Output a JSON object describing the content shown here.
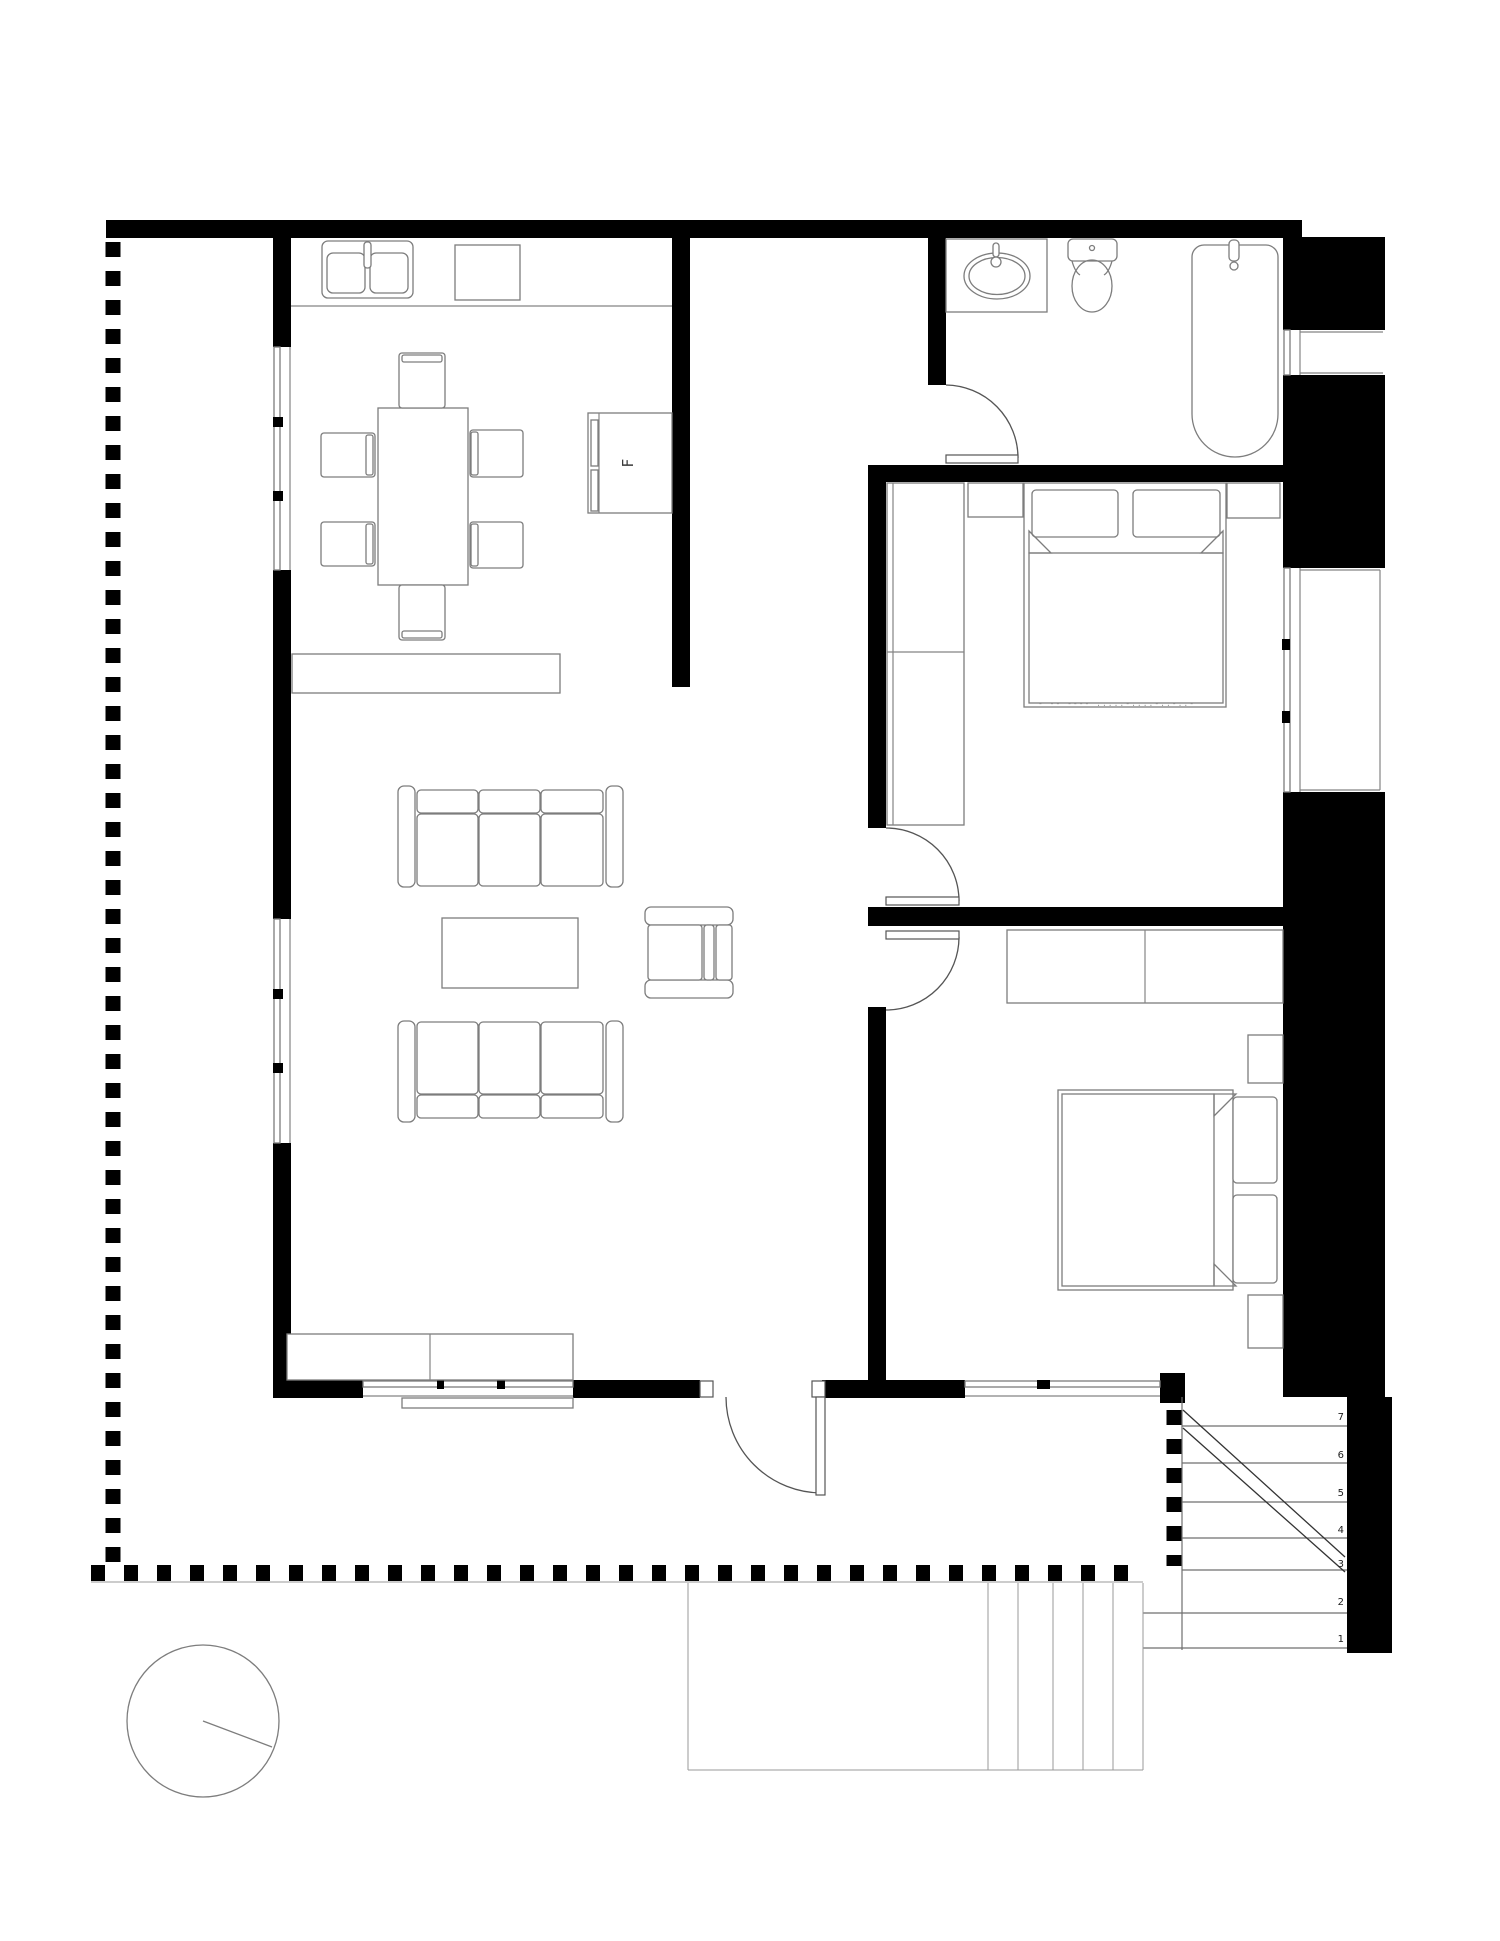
{
  "plan": {
    "fridge_label": "F",
    "bed_label": "- -- ---- .....-....-..-..-",
    "stair_steps": [
      "7",
      "6",
      "5",
      "4",
      "3",
      "2",
      "1"
    ]
  }
}
